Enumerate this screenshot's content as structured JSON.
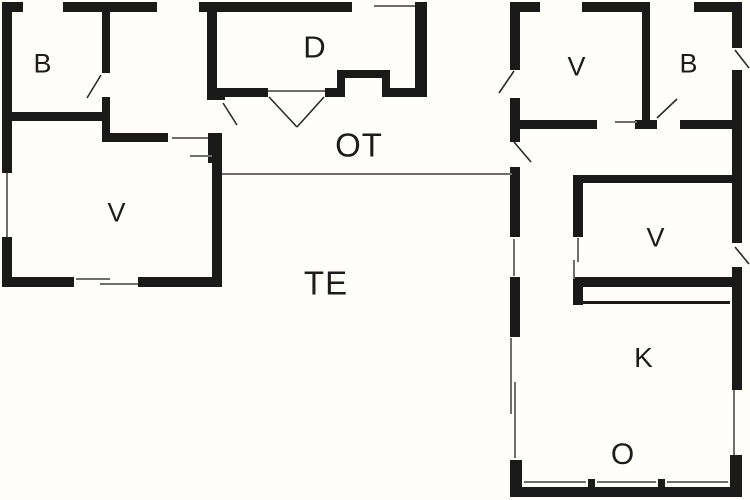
{
  "title": "Floor plan",
  "canvas": {
    "width": 750,
    "height": 500,
    "background": "#fffefa",
    "wall_color": "#1a1a1a",
    "window_line_color": "#6e6e6e",
    "door_swing_color": "#2a2a2a",
    "label_color": "#1c1c1c"
  },
  "rooms": [
    {
      "id": "b-left",
      "label": "B",
      "x": 43,
      "y": 64,
      "size": 27
    },
    {
      "id": "d",
      "label": "D",
      "x": 315,
      "y": 47,
      "size": 31
    },
    {
      "id": "v-left",
      "label": "V",
      "x": 117,
      "y": 213,
      "size": 27
    },
    {
      "id": "ot",
      "label": "OT",
      "x": 359,
      "y": 145,
      "size": 33
    },
    {
      "id": "te",
      "label": "TE",
      "x": 326,
      "y": 283,
      "size": 33
    },
    {
      "id": "v-right-top",
      "label": "V",
      "x": 577,
      "y": 67,
      "size": 27
    },
    {
      "id": "b-right",
      "label": "B",
      "x": 689,
      "y": 64,
      "size": 27
    },
    {
      "id": "v-right-mid",
      "label": "V",
      "x": 656,
      "y": 238,
      "size": 27
    },
    {
      "id": "k",
      "label": "K",
      "x": 644,
      "y": 358,
      "size": 28
    },
    {
      "id": "o",
      "label": "O",
      "x": 623,
      "y": 455,
      "size": 30
    }
  ],
  "plan": {
    "walls": [
      [
        2,
        2,
        21,
        10
      ],
      [
        63,
        2,
        94,
        10
      ],
      [
        199,
        2,
        153,
        10
      ],
      [
        415,
        2,
        12,
        10
      ],
      [
        415,
        10,
        12,
        87
      ],
      [
        2,
        12,
        10,
        161
      ],
      [
        2,
        237,
        10,
        49
      ],
      [
        2,
        112,
        108,
        9
      ],
      [
        102,
        12,
        8,
        61
      ],
      [
        102,
        97,
        8,
        45
      ],
      [
        102,
        133,
        66,
        9
      ],
      [
        208,
        133,
        14,
        30
      ],
      [
        207,
        12,
        10,
        76
      ],
      [
        207,
        88,
        18,
        12
      ],
      [
        217,
        88,
        51,
        9
      ],
      [
        325,
        88,
        20,
        9
      ],
      [
        337,
        70,
        8,
        27
      ],
      [
        337,
        70,
        53,
        8
      ],
      [
        382,
        70,
        8,
        27
      ],
      [
        390,
        88,
        37,
        9
      ],
      [
        212,
        163,
        10,
        123
      ],
      [
        2,
        277,
        72,
        10
      ],
      [
        138,
        277,
        84,
        10
      ],
      [
        510,
        2,
        30,
        10
      ],
      [
        582,
        2,
        68,
        10
      ],
      [
        694,
        2,
        48,
        10
      ],
      [
        732,
        12,
        10,
        36
      ],
      [
        732,
        70,
        10,
        173
      ],
      [
        732,
        267,
        10,
        123
      ],
      [
        730,
        455,
        12,
        42
      ],
      [
        510,
        12,
        10,
        58
      ],
      [
        510,
        98,
        10,
        44
      ],
      [
        510,
        167,
        10,
        70
      ],
      [
        510,
        277,
        10,
        60
      ],
      [
        510,
        460,
        12,
        37
      ],
      [
        510,
        487,
        232,
        10
      ],
      [
        588,
        479,
        7,
        8
      ],
      [
        658,
        479,
        7,
        8
      ],
      [
        520,
        120,
        77,
        9
      ],
      [
        635,
        120,
        22,
        9
      ],
      [
        680,
        120,
        62,
        9
      ],
      [
        642,
        12,
        8,
        108
      ],
      [
        575,
        175,
        157,
        8
      ],
      [
        573,
        175,
        10,
        62
      ],
      [
        573,
        277,
        159,
        10
      ],
      [
        573,
        277,
        10,
        28
      ],
      [
        577,
        301,
        153,
        3
      ]
    ],
    "window_lines": [
      [
        374,
        6,
        415,
        6
      ],
      [
        7,
        173,
        7,
        237
      ],
      [
        76,
        279,
        110,
        279
      ],
      [
        100,
        284,
        138,
        284
      ],
      [
        172,
        138,
        208,
        138
      ],
      [
        190,
        156,
        212,
        156
      ],
      [
        268,
        91,
        325,
        91
      ],
      [
        615,
        122,
        637,
        122
      ],
      [
        514,
        239,
        514,
        276
      ],
      [
        511,
        338,
        511,
        414
      ],
      [
        515,
        382,
        515,
        458
      ],
      [
        734,
        390,
        734,
        455
      ],
      [
        578,
        238,
        578,
        262
      ],
      [
        574,
        260,
        574,
        279
      ],
      [
        524,
        482,
        586,
        482
      ],
      [
        597,
        482,
        656,
        482
      ],
      [
        667,
        482,
        728,
        482
      ],
      [
        222,
        174,
        512,
        174
      ]
    ],
    "door_swings": [
      [
        101,
        75,
        87,
        98
      ],
      [
        223,
        103,
        237,
        125
      ],
      [
        269,
        97,
        297,
        127
      ],
      [
        324,
        97,
        297,
        127
      ],
      [
        514,
        71,
        499,
        93
      ],
      [
        514,
        142,
        531,
        162
      ],
      [
        735,
        50,
        749,
        68
      ],
      [
        657,
        118,
        677,
        99
      ],
      [
        735,
        247,
        749,
        264
      ]
    ]
  }
}
